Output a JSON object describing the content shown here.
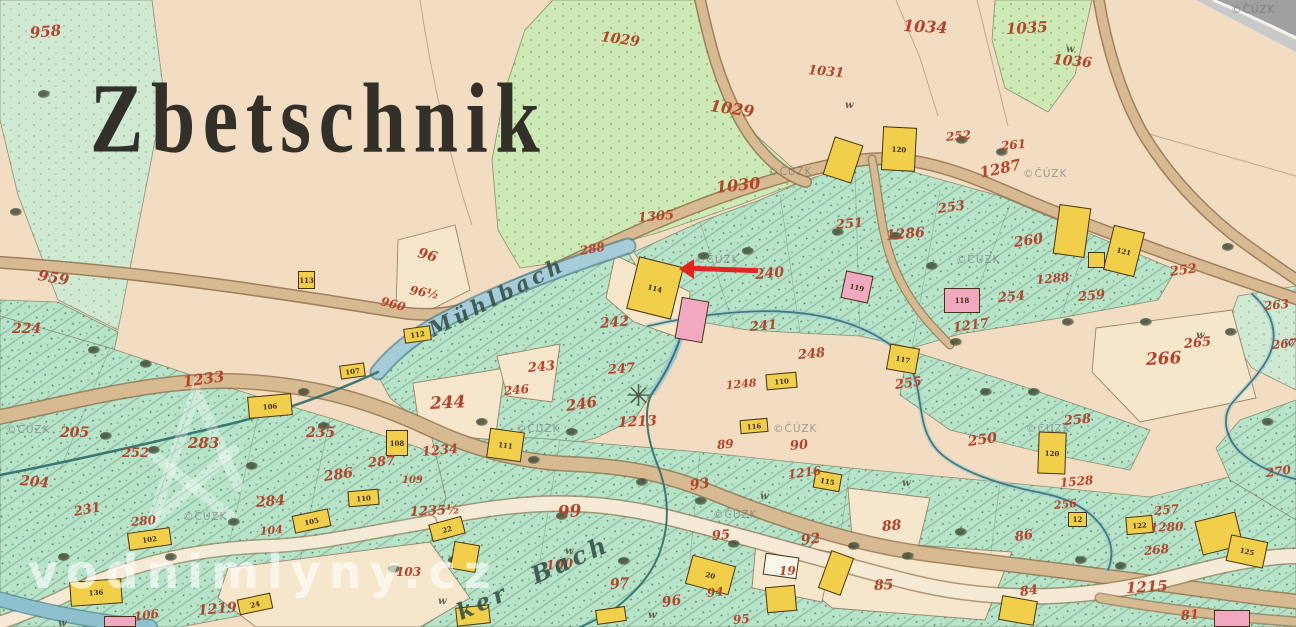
{
  "map": {
    "title": {
      "text": "Zbetschnik"
    },
    "colors": {
      "paper": "#f3ddc2",
      "meadow": "#cde9b5",
      "field_teal": "#b7e3c9",
      "road_tan": "#d8ba92",
      "road_edge": "#8f6f4a",
      "stream": "#9dc6d6",
      "stream_dark": "#2e6b6b",
      "building_yellow": "#f2cf4a",
      "building_pink": "#f0a9c0",
      "parcel_red": "#b5432a",
      "ink": "#33302a",
      "arrow_red": "#e4251f"
    },
    "annotation_arrow": {
      "tip_x": 681,
      "tip_y": 269,
      "tail_x": 758,
      "tail_y": 272
    },
    "stream_names": [
      {
        "t": "Mühlbach",
        "x": 430,
        "y": 318,
        "r": -27,
        "s": 21
      },
      {
        "t": "ker",
        "x": 458,
        "y": 600,
        "r": -24,
        "s": 23
      },
      {
        "t": "Bach",
        "x": 532,
        "y": 562,
        "r": -24,
        "s": 24
      }
    ],
    "parcel_numbers": [
      {
        "t": "958",
        "x": 30,
        "y": 26,
        "s": 15,
        "r": -5
      },
      {
        "t": "959",
        "x": 38,
        "y": 268,
        "s": 15,
        "r": 10
      },
      {
        "t": "224",
        "x": 12,
        "y": 322,
        "s": 14,
        "r": 0
      },
      {
        "t": "204",
        "x": 20,
        "y": 474,
        "s": 14,
        "r": 5
      },
      {
        "t": "205",
        "x": 60,
        "y": 426,
        "s": 14,
        "r": 0
      },
      {
        "t": "252",
        "x": 122,
        "y": 447,
        "s": 13,
        "r": 0
      },
      {
        "t": "231",
        "x": 74,
        "y": 506,
        "s": 13,
        "r": -10
      },
      {
        "t": "283",
        "x": 188,
        "y": 436,
        "s": 15,
        "r": 0
      },
      {
        "t": "235",
        "x": 306,
        "y": 426,
        "s": 14,
        "r": 0
      },
      {
        "t": "1233",
        "x": 183,
        "y": 375,
        "s": 15,
        "r": -8
      },
      {
        "t": "284",
        "x": 256,
        "y": 496,
        "s": 14,
        "r": -5
      },
      {
        "t": "280",
        "x": 131,
        "y": 516,
        "s": 12,
        "r": -5
      },
      {
        "t": "286",
        "x": 324,
        "y": 470,
        "s": 14,
        "r": -8
      },
      {
        "t": "287",
        "x": 368,
        "y": 457,
        "s": 13,
        "r": -5
      },
      {
        "t": "1234",
        "x": 422,
        "y": 446,
        "s": 13,
        "r": -5
      },
      {
        "t": "109",
        "x": 402,
        "y": 476,
        "s": 10,
        "r": 0
      },
      {
        "t": "104",
        "x": 260,
        "y": 526,
        "s": 11,
        "r": -5
      },
      {
        "t": "1235½",
        "x": 410,
        "y": 506,
        "s": 13,
        "r": -3
      },
      {
        "t": "103",
        "x": 396,
        "y": 566,
        "s": 12,
        "r": 0
      },
      {
        "t": "1219",
        "x": 198,
        "y": 604,
        "s": 14,
        "r": -5
      },
      {
        "t": "106",
        "x": 134,
        "y": 611,
        "s": 12,
        "r": -8
      },
      {
        "t": "96",
        "x": 418,
        "y": 246,
        "s": 14,
        "r": 15
      },
      {
        "t": "96½",
        "x": 410,
        "y": 284,
        "s": 12,
        "r": 10
      },
      {
        "t": "960",
        "x": 381,
        "y": 295,
        "s": 12,
        "r": 15
      },
      {
        "t": "288",
        "x": 580,
        "y": 245,
        "s": 12,
        "r": -10
      },
      {
        "t": "242",
        "x": 600,
        "y": 317,
        "s": 14,
        "r": -5
      },
      {
        "t": "243",
        "x": 528,
        "y": 362,
        "s": 13,
        "r": -5
      },
      {
        "t": "244",
        "x": 430,
        "y": 396,
        "s": 17,
        "r": -3
      },
      {
        "t": "246",
        "x": 504,
        "y": 385,
        "s": 12,
        "r": -5
      },
      {
        "t": "246",
        "x": 566,
        "y": 399,
        "s": 15,
        "r": -8
      },
      {
        "t": "247",
        "x": 608,
        "y": 364,
        "s": 13,
        "r": -5
      },
      {
        "t": "1213",
        "x": 618,
        "y": 416,
        "s": 14,
        "r": -3
      },
      {
        "t": "1029",
        "x": 601,
        "y": 30,
        "s": 14,
        "r": 8
      },
      {
        "t": "1029",
        "x": 710,
        "y": 98,
        "s": 16,
        "r": 8
      },
      {
        "t": "1030",
        "x": 716,
        "y": 180,
        "s": 16,
        "r": -6
      },
      {
        "t": "1305",
        "x": 638,
        "y": 212,
        "s": 13,
        "r": -5
      },
      {
        "t": "1031",
        "x": 808,
        "y": 64,
        "s": 13,
        "r": 5
      },
      {
        "t": "1034",
        "x": 903,
        "y": 18,
        "s": 16,
        "r": 3
      },
      {
        "t": "1035",
        "x": 1006,
        "y": 22,
        "s": 15,
        "r": -3
      },
      {
        "t": "1036",
        "x": 1053,
        "y": 53,
        "s": 14,
        "r": 5
      },
      {
        "t": "252",
        "x": 946,
        "y": 131,
        "s": 12,
        "r": -5
      },
      {
        "t": "261",
        "x": 1001,
        "y": 140,
        "s": 12,
        "r": -5
      },
      {
        "t": "1287",
        "x": 980,
        "y": 166,
        "s": 15,
        "r": -12
      },
      {
        "t": "253",
        "x": 938,
        "y": 203,
        "s": 13,
        "r": -8
      },
      {
        "t": "251",
        "x": 836,
        "y": 219,
        "s": 13,
        "r": -5
      },
      {
        "t": "1286",
        "x": 886,
        "y": 229,
        "s": 14,
        "r": -5
      },
      {
        "t": "260",
        "x": 1014,
        "y": 236,
        "s": 14,
        "r": -8
      },
      {
        "t": "252",
        "x": 1170,
        "y": 266,
        "s": 13,
        "r": -8
      },
      {
        "t": "1288",
        "x": 1036,
        "y": 274,
        "s": 12,
        "r": -5
      },
      {
        "t": "259",
        "x": 1078,
        "y": 291,
        "s": 13,
        "r": -5
      },
      {
        "t": "254",
        "x": 998,
        "y": 292,
        "s": 13,
        "r": -5
      },
      {
        "t": "240",
        "x": 755,
        "y": 268,
        "s": 14,
        "r": -5
      },
      {
        "t": "241",
        "x": 750,
        "y": 321,
        "s": 13,
        "r": -5
      },
      {
        "t": "248",
        "x": 798,
        "y": 349,
        "s": 13,
        "r": -5
      },
      {
        "t": "1248",
        "x": 726,
        "y": 380,
        "s": 11,
        "r": -5
      },
      {
        "t": "255",
        "x": 895,
        "y": 379,
        "s": 13,
        "r": -8
      },
      {
        "t": "1217",
        "x": 953,
        "y": 322,
        "s": 13,
        "r": -8
      },
      {
        "t": "250",
        "x": 968,
        "y": 435,
        "s": 14,
        "r": -8
      },
      {
        "t": "258",
        "x": 1064,
        "y": 415,
        "s": 13,
        "r": -5
      },
      {
        "t": "1528",
        "x": 1060,
        "y": 477,
        "s": 12,
        "r": -5
      },
      {
        "t": "256",
        "x": 1054,
        "y": 500,
        "s": 11,
        "r": -5
      },
      {
        "t": "257",
        "x": 1154,
        "y": 505,
        "s": 12,
        "r": -5
      },
      {
        "t": "1280",
        "x": 1150,
        "y": 522,
        "s": 12,
        "r": -3
      },
      {
        "t": "268",
        "x": 1144,
        "y": 545,
        "s": 12,
        "r": -5
      },
      {
        "t": "266",
        "x": 1146,
        "y": 352,
        "s": 17,
        "r": -3
      },
      {
        "t": "265",
        "x": 1184,
        "y": 338,
        "s": 13,
        "r": -5
      },
      {
        "t": "263",
        "x": 1264,
        "y": 300,
        "s": 12,
        "r": -5
      },
      {
        "t": "267",
        "x": 1272,
        "y": 339,
        "s": 12,
        "r": -5
      },
      {
        "t": "270",
        "x": 1266,
        "y": 467,
        "s": 12,
        "r": -8
      },
      {
        "t": "99",
        "x": 558,
        "y": 505,
        "s": 17,
        "r": -5
      },
      {
        "t": "100",
        "x": 546,
        "y": 560,
        "s": 13,
        "r": -5
      },
      {
        "t": "97",
        "x": 610,
        "y": 578,
        "s": 14,
        "r": -5
      },
      {
        "t": "93",
        "x": 690,
        "y": 479,
        "s": 14,
        "r": -8
      },
      {
        "t": "95",
        "x": 712,
        "y": 530,
        "s": 13,
        "r": -5
      },
      {
        "t": "96",
        "x": 662,
        "y": 596,
        "s": 14,
        "r": -8
      },
      {
        "t": "94",
        "x": 707,
        "y": 587,
        "s": 12,
        "r": -5
      },
      {
        "t": "92",
        "x": 801,
        "y": 534,
        "s": 14,
        "r": -8
      },
      {
        "t": "19",
        "x": 779,
        "y": 565,
        "s": 12,
        "r": 0
      },
      {
        "t": "1216",
        "x": 788,
        "y": 469,
        "s": 12,
        "r": -8
      },
      {
        "t": "90",
        "x": 790,
        "y": 440,
        "s": 13,
        "r": -5
      },
      {
        "t": "89",
        "x": 717,
        "y": 439,
        "s": 12,
        "r": -5
      },
      {
        "t": "85",
        "x": 874,
        "y": 579,
        "s": 14,
        "r": -3
      },
      {
        "t": "88",
        "x": 882,
        "y": 520,
        "s": 14,
        "r": -5
      },
      {
        "t": "84",
        "x": 1020,
        "y": 586,
        "s": 13,
        "r": -8
      },
      {
        "t": "86",
        "x": 1015,
        "y": 531,
        "s": 13,
        "r": -8
      },
      {
        "t": "1215",
        "x": 1126,
        "y": 581,
        "s": 15,
        "r": -3
      },
      {
        "t": "81",
        "x": 1181,
        "y": 610,
        "s": 13,
        "r": -5
      },
      {
        "t": "95",
        "x": 733,
        "y": 614,
        "s": 12,
        "r": -5
      }
    ],
    "buildings": [
      {
        "x": 828,
        "y": 140,
        "w": 30,
        "h": 40,
        "r": 18,
        "c": "y"
      },
      {
        "x": 882,
        "y": 127,
        "w": 34,
        "h": 44,
        "r": 3,
        "c": "y",
        "l": "120"
      },
      {
        "x": 632,
        "y": 261,
        "w": 46,
        "h": 54,
        "r": 14,
        "c": "y",
        "l": "114"
      },
      {
        "x": 678,
        "y": 299,
        "w": 28,
        "h": 42,
        "r": 10,
        "c": "p"
      },
      {
        "x": 298,
        "y": 271,
        "w": 17,
        "h": 18,
        "r": 0,
        "c": "y",
        "l": "113"
      },
      {
        "x": 404,
        "y": 327,
        "w": 27,
        "h": 15,
        "r": -8,
        "c": "y",
        "l": "112"
      },
      {
        "x": 248,
        "y": 395,
        "w": 44,
        "h": 22,
        "r": -5,
        "c": "y",
        "l": "106"
      },
      {
        "x": 340,
        "y": 364,
        "w": 25,
        "h": 14,
        "r": -8,
        "c": "y",
        "l": "107"
      },
      {
        "x": 386,
        "y": 430,
        "w": 22,
        "h": 26,
        "r": 0,
        "c": "y",
        "l": "108"
      },
      {
        "x": 348,
        "y": 490,
        "w": 31,
        "h": 16,
        "r": -5,
        "c": "y",
        "l": "110"
      },
      {
        "x": 293,
        "y": 512,
        "w": 37,
        "h": 18,
        "r": -12,
        "c": "y",
        "l": "105"
      },
      {
        "x": 128,
        "y": 530,
        "w": 43,
        "h": 18,
        "r": -8,
        "c": "y",
        "l": "102"
      },
      {
        "x": 70,
        "y": 580,
        "w": 52,
        "h": 25,
        "r": -4,
        "c": "y",
        "l": "136"
      },
      {
        "x": 238,
        "y": 596,
        "w": 34,
        "h": 16,
        "r": -12,
        "c": "y",
        "l": "24"
      },
      {
        "x": 430,
        "y": 520,
        "w": 34,
        "h": 18,
        "r": -15,
        "c": "y",
        "l": "22"
      },
      {
        "x": 452,
        "y": 543,
        "w": 26,
        "h": 28,
        "r": 10,
        "c": "y"
      },
      {
        "x": 488,
        "y": 430,
        "w": 35,
        "h": 30,
        "r": 8,
        "c": "y",
        "l": "111"
      },
      {
        "x": 740,
        "y": 419,
        "w": 28,
        "h": 14,
        "r": -5,
        "c": "y",
        "l": "116"
      },
      {
        "x": 766,
        "y": 373,
        "w": 31,
        "h": 16,
        "r": -5,
        "c": "y",
        "l": "110"
      },
      {
        "x": 888,
        "y": 346,
        "w": 30,
        "h": 26,
        "r": 10,
        "c": "y",
        "l": "117"
      },
      {
        "x": 843,
        "y": 273,
        "w": 28,
        "h": 28,
        "r": 12,
        "c": "p",
        "l": "119"
      },
      {
        "x": 944,
        "y": 288,
        "w": 36,
        "h": 25,
        "r": 0,
        "c": "p",
        "l": "118"
      },
      {
        "x": 1056,
        "y": 206,
        "w": 32,
        "h": 50,
        "r": 8,
        "c": "y"
      },
      {
        "x": 1108,
        "y": 228,
        "w": 32,
        "h": 46,
        "r": 14,
        "c": "y",
        "l": "121"
      },
      {
        "x": 1088,
        "y": 252,
        "w": 17,
        "h": 16,
        "r": 0,
        "c": "y"
      },
      {
        "x": 1038,
        "y": 432,
        "w": 28,
        "h": 42,
        "r": 2,
        "c": "y",
        "l": "120"
      },
      {
        "x": 814,
        "y": 472,
        "w": 27,
        "h": 18,
        "r": 10,
        "c": "y",
        "l": "115"
      },
      {
        "x": 688,
        "y": 560,
        "w": 45,
        "h": 30,
        "r": 15,
        "c": "y",
        "l": "20"
      },
      {
        "x": 1068,
        "y": 512,
        "w": 19,
        "h": 15,
        "r": 0,
        "c": "y",
        "l": "12"
      },
      {
        "x": 1126,
        "y": 516,
        "w": 27,
        "h": 18,
        "r": -5,
        "c": "y",
        "l": "122"
      },
      {
        "x": 1198,
        "y": 516,
        "w": 42,
        "h": 35,
        "r": -14,
        "c": "y"
      },
      {
        "x": 1228,
        "y": 538,
        "w": 38,
        "h": 27,
        "r": 12,
        "c": "y",
        "l": "125"
      },
      {
        "x": 764,
        "y": 555,
        "w": 34,
        "h": 22,
        "r": 8,
        "c": "w"
      },
      {
        "x": 766,
        "y": 586,
        "w": 30,
        "h": 26,
        "r": -5,
        "c": "y"
      },
      {
        "x": 824,
        "y": 553,
        "w": 24,
        "h": 40,
        "r": 20,
        "c": "y"
      },
      {
        "x": 456,
        "y": 606,
        "w": 34,
        "h": 19,
        "r": -6,
        "c": "y"
      },
      {
        "x": 1000,
        "y": 598,
        "w": 36,
        "h": 25,
        "r": 10,
        "c": "y"
      },
      {
        "x": 1214,
        "y": 610,
        "w": 36,
        "h": 17,
        "r": 0,
        "c": "p"
      },
      {
        "x": 104,
        "y": 616,
        "w": 32,
        "h": 11,
        "r": 0,
        "c": "p"
      },
      {
        "x": 596,
        "y": 608,
        "w": 30,
        "h": 15,
        "r": -8,
        "c": "y"
      }
    ],
    "trees": [
      [
        38,
        90
      ],
      [
        10,
        208
      ],
      [
        100,
        432
      ],
      [
        148,
        446
      ],
      [
        298,
        388
      ],
      [
        318,
        422
      ],
      [
        228,
        518
      ],
      [
        165,
        553
      ],
      [
        58,
        553
      ],
      [
        388,
        565
      ],
      [
        448,
        556
      ],
      [
        528,
        456
      ],
      [
        556,
        512
      ],
      [
        618,
        557
      ],
      [
        695,
        497
      ],
      [
        728,
        540
      ],
      [
        848,
        542
      ],
      [
        902,
        552
      ],
      [
        955,
        528
      ],
      [
        1075,
        556
      ],
      [
        1115,
        562
      ],
      [
        698,
        252
      ],
      [
        742,
        247
      ],
      [
        832,
        228
      ],
      [
        890,
        232
      ],
      [
        926,
        262
      ],
      [
        950,
        338
      ],
      [
        980,
        388
      ],
      [
        1028,
        388
      ],
      [
        1062,
        318
      ],
      [
        1140,
        318
      ],
      [
        1225,
        328
      ],
      [
        1262,
        418
      ],
      [
        1222,
        243
      ],
      [
        956,
        136
      ],
      [
        996,
        148
      ],
      [
        476,
        418
      ],
      [
        566,
        428
      ],
      [
        636,
        478
      ],
      [
        246,
        462
      ],
      [
        88,
        346
      ],
      [
        140,
        360
      ]
    ],
    "w_marks": {
      "glyph": "w",
      "positions": [
        [
          845,
          100
        ],
        [
          1066,
          44
        ],
        [
          760,
          491
        ],
        [
          648,
          610
        ],
        [
          565,
          546
        ],
        [
          1196,
          330
        ],
        [
          1284,
          338
        ],
        [
          902,
          478
        ],
        [
          58,
          618
        ],
        [
          438,
          596
        ]
      ]
    },
    "mill_symbol": {
      "glyph": "✳",
      "x": 626,
      "y": 382
    },
    "watermarks": {
      "cuzk_text": "©ČÚZK",
      "cuzk_positions": [
        [
          695,
          254
        ],
        [
          768,
          166
        ],
        [
          1023,
          168
        ],
        [
          956,
          254
        ],
        [
          516,
          423
        ],
        [
          773,
          423
        ],
        [
          1026,
          423
        ],
        [
          713,
          509
        ],
        [
          183,
          511
        ],
        [
          6,
          424
        ],
        [
          1231,
          4
        ]
      ],
      "site_text": "vodnimlyny.cz",
      "site_x": 28,
      "site_y": 545
    }
  }
}
